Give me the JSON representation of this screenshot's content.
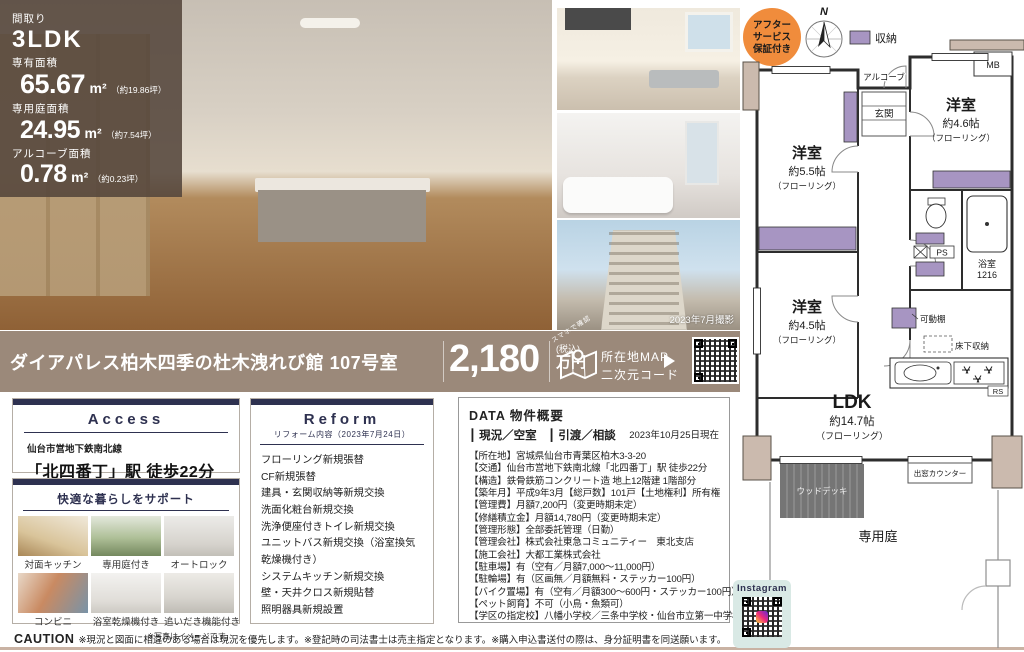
{
  "overlay": {
    "madori_label": "間取り",
    "madori": "3LDK",
    "area_label": "専有面積",
    "area": "65.67",
    "area_unit": "m²",
    "area_tsubo": "（約19.86坪）",
    "garden_label": "専用庭面積",
    "garden": "24.95",
    "garden_unit": "m²",
    "garden_tsubo": "（約7.54坪）",
    "alcove_label": "アルコーブ面積",
    "alcove": "0.78",
    "alcove_unit": "m²",
    "alcove_tsubo": "（約0.23坪）"
  },
  "photos": {
    "date_note": "2023年7月撮影"
  },
  "banner": {
    "name": "ダイアパレス柏木四季の杜木洩れび館 107号室",
    "price": "2,180",
    "tax": "(税込)",
    "unit": "万円",
    "map_hint": "スマホで確認",
    "map_line1": "所在地MAP",
    "map_line2": "二次元コード"
  },
  "access": {
    "title": "Access",
    "line_small": "仙台市営地下鉄南北線",
    "line_big": "「北四番丁」駅 徒歩22分"
  },
  "support": {
    "title": "快適な暮らしをサポート",
    "items": [
      "対面キッチン",
      "専用庭付き",
      "オートロック",
      "コンビニ",
      "浴室乾燥機付き",
      "追いだき機能付き"
    ],
    "note": "※写真はイメージです。"
  },
  "reform": {
    "title": "Reform",
    "subtitle": "リフォーム内容（2023年7月24日）",
    "items": [
      "フローリング新規張替",
      "CF新規張替",
      "建具・玄関収納等新規交換",
      "洗面化粧台新規交換",
      "洗浄便座付きトイレ新規交換",
      "ユニットバス新規交換（浴室換気乾燥機付き）",
      "システムキッチン新規交換",
      "壁・天井クロス新規貼替",
      "照明器具新規設置"
    ]
  },
  "data_box": {
    "title": "DATA 物件概要",
    "status": "┃ 現況／空室　┃ 引渡／相談",
    "date": "2023年10月25日現在",
    "rows": [
      "【所在地】宮城県仙台市青葉区柏木3-3-20",
      "【交通】仙台市営地下鉄南北線「北四番丁」駅 徒歩22分",
      "【構造】鉄骨鉄筋コンクリート造 地上12階建 1階部分",
      "【築年月】平成9年3月【総戸数】101戸【土地権利】所有権",
      "【管理費】月額7,200円（変更時期未定）",
      "【修繕積立金】月額14,780円（変更時期未定）",
      "【管理形態】全部委託管理（日勤）",
      "【管理会社】株式会社東急コミュニティー　東北支店",
      "【施工会社】大都工業株式会社",
      "【駐車場】有（空有／月額7,000～11,000円）",
      "【駐輪場】有（区画無／月額無料・ステッカー100円）",
      "【バイク置場】有（空有／月額300～600円・ステッカー100円）",
      "【ペット飼育】不可（小鳥・魚類可）",
      "【学区の指定校】八幡小学校／三条中学校・仙台市立第一中学校"
    ]
  },
  "caution": {
    "label": "CAUTION",
    "text": "※現況と図面に相違のある場合は現況を優先します。※登記時の司法書士は売主指定となります。※購入申込書送付の際は、身分証明書を同送願います。"
  },
  "floorplan": {
    "badge_lines": [
      "アフター",
      "サービス",
      "保証付き"
    ],
    "compass_n": "N",
    "legend_storage": "収納",
    "mb": "MB",
    "alcove": "アルコーブ",
    "genkan": "玄関",
    "room55": {
      "name": "洋室",
      "size": "約5.5帖",
      "floor": "（フローリング）"
    },
    "room46": {
      "name": "洋室",
      "size": "約4.6帖",
      "floor": "（フローリング）"
    },
    "room45": {
      "name": "洋室",
      "size": "約4.5帖",
      "floor": "（フローリング）"
    },
    "ldk": {
      "name": "LDK",
      "size": "約14.7帖",
      "floor": "（フローリング）"
    },
    "bath": {
      "name": "浴室",
      "size": "1216"
    },
    "ps": "PS",
    "rs": "RS",
    "kadodana": "可動棚",
    "yukashita": "床下収納",
    "demado": "出窓カウンター",
    "wooddeck": "ウッドデッキ",
    "garden": "専用庭"
  },
  "instagram": {
    "label": "Instagram"
  }
}
